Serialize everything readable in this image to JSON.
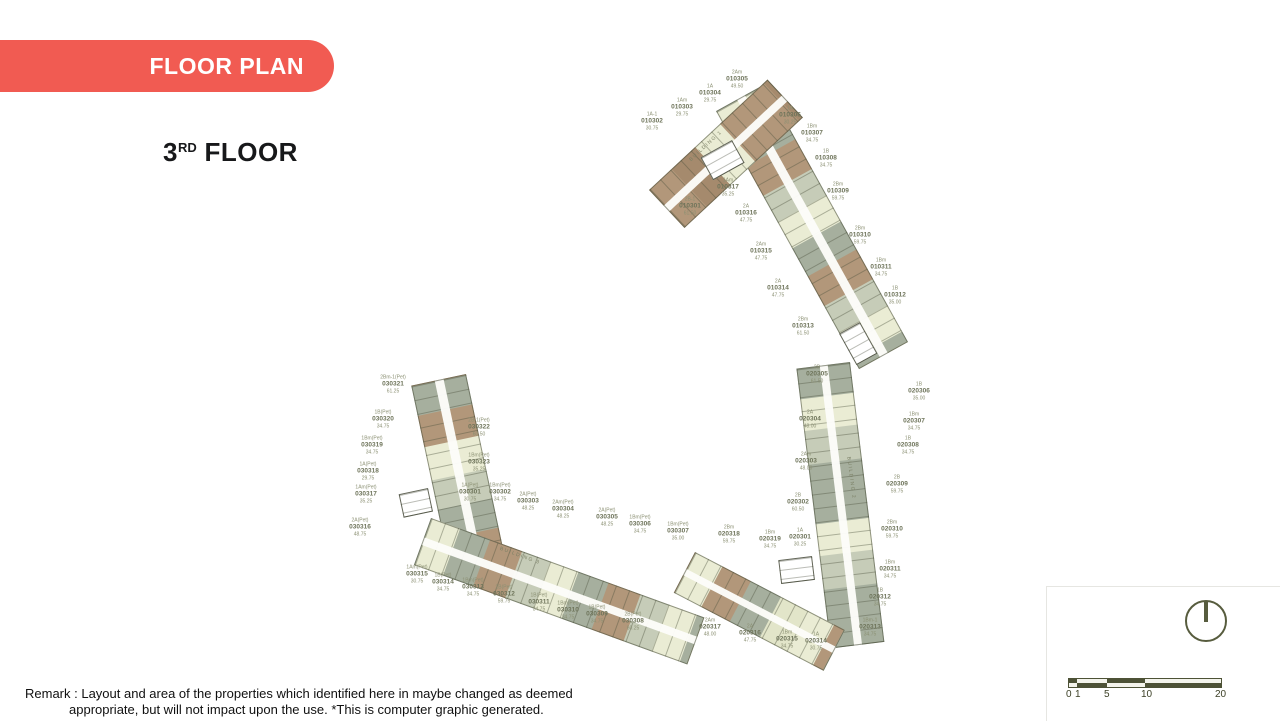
{
  "slide": {
    "badge_label": "FLOOR PLAN",
    "badge_color": "#f15b52",
    "floor_number": "3",
    "floor_suffix": "RD",
    "floor_word": " FLOOR"
  },
  "remark": {
    "line1": "Remark : Layout  and area of the properties which identified here in maybe changed as deemed",
    "line2": "appropriate, but will not impact upon the use. *This is computer graphic generated."
  },
  "scalebar": {
    "values": [
      "0",
      "1",
      "5",
      "10",
      "20"
    ],
    "dark": "#4d5236",
    "light": "#f4f4ec"
  },
  "compass": {
    "icon": "north-indicator",
    "color": "#575c3e"
  },
  "palette": {
    "tan": "#b2977a",
    "tan2": "#a58a6d",
    "sage": "#a6af9e",
    "sage2": "#c6ccb8",
    "cream": "#eaecd4",
    "cream2": "#e2e5c9",
    "outline": "#6b7058",
    "label": "#8b9073",
    "label_strong": "#6e745a"
  },
  "buildings": [
    {
      "name": "BUILDING 1",
      "units": [
        {
          "type": "2B-1",
          "no": "010301",
          "area": "61.50",
          "x": 690,
          "y": 207
        },
        {
          "type": "1A-1",
          "no": "010302",
          "area": "30.75",
          "x": 652,
          "y": 122
        },
        {
          "type": "1Am",
          "no": "010303",
          "area": "29.75",
          "x": 682,
          "y": 108
        },
        {
          "type": "1A",
          "no": "010304",
          "area": "29.75",
          "x": 710,
          "y": 94
        },
        {
          "type": "2Am",
          "no": "010305",
          "area": "49.50",
          "x": 737,
          "y": 80
        },
        {
          "type": "1A",
          "no": "010306",
          "area": "30.25",
          "x": 790,
          "y": 116
        },
        {
          "type": "1Bm",
          "no": "010307",
          "area": "34.75",
          "x": 812,
          "y": 134
        },
        {
          "type": "1B",
          "no": "010308",
          "area": "34.75",
          "x": 826,
          "y": 159
        },
        {
          "type": "2Bm",
          "no": "010309",
          "area": "59.75",
          "x": 838,
          "y": 192
        },
        {
          "type": "2Bm",
          "no": "010310",
          "area": "59.75",
          "x": 860,
          "y": 236
        },
        {
          "type": "1Bm",
          "no": "010311",
          "area": "34.75",
          "x": 881,
          "y": 268
        },
        {
          "type": "1B",
          "no": "010312",
          "area": "35.00",
          "x": 895,
          "y": 296
        },
        {
          "type": "2Bm",
          "no": "010313",
          "area": "61.50",
          "x": 803,
          "y": 327
        },
        {
          "type": "2A",
          "no": "010314",
          "area": "47.75",
          "x": 778,
          "y": 289
        },
        {
          "type": "2Am",
          "no": "010315",
          "area": "47.75",
          "x": 761,
          "y": 252
        },
        {
          "type": "2A",
          "no": "010316",
          "area": "47.75",
          "x": 746,
          "y": 214
        },
        {
          "type": "1Am",
          "no": "010317",
          "area": "35.25",
          "x": 728,
          "y": 188
        }
      ]
    },
    {
      "name": "BUILDING 2",
      "units": [
        {
          "type": "1A",
          "no": "020301",
          "area": "30.25",
          "x": 800,
          "y": 538
        },
        {
          "type": "2B",
          "no": "020302",
          "area": "60.50",
          "x": 798,
          "y": 503
        },
        {
          "type": "2Am",
          "no": "020303",
          "area": "48.00",
          "x": 806,
          "y": 462
        },
        {
          "type": "2A",
          "no": "020304",
          "area": "48.00",
          "x": 810,
          "y": 420
        },
        {
          "type": "2B",
          "no": "020305",
          "area": "61.50",
          "x": 817,
          "y": 375
        },
        {
          "type": "1B",
          "no": "020306",
          "area": "35.00",
          "x": 919,
          "y": 392
        },
        {
          "type": "1Bm",
          "no": "020307",
          "area": "34.75",
          "x": 914,
          "y": 422
        },
        {
          "type": "1B",
          "no": "020308",
          "area": "34.75",
          "x": 908,
          "y": 446
        },
        {
          "type": "2B",
          "no": "020309",
          "area": "59.75",
          "x": 897,
          "y": 485
        },
        {
          "type": "2Bm",
          "no": "020310",
          "area": "59.75",
          "x": 892,
          "y": 530
        },
        {
          "type": "1Bm",
          "no": "020311",
          "area": "34.75",
          "x": 890,
          "y": 570
        },
        {
          "type": "1B",
          "no": "020312",
          "area": "34.75",
          "x": 880,
          "y": 598
        },
        {
          "type": "1Bm-1",
          "no": "020313",
          "area": "34.75",
          "x": 870,
          "y": 628
        },
        {
          "type": "1A",
          "no": "020314",
          "area": "30.75",
          "x": 816,
          "y": 642
        },
        {
          "type": "1Bm",
          "no": "020315",
          "area": "34.75",
          "x": 787,
          "y": 640
        },
        {
          "type": "2A",
          "no": "020316",
          "area": "47.75",
          "x": 750,
          "y": 634
        },
        {
          "type": "2Am",
          "no": "020317",
          "area": "48.00",
          "x": 710,
          "y": 628
        },
        {
          "type": "2Bm",
          "no": "020318",
          "area": "59.75",
          "x": 729,
          "y": 535
        },
        {
          "type": "1Bm",
          "no": "020319",
          "area": "34.75",
          "x": 770,
          "y": 540
        }
      ]
    },
    {
      "name": "BUILDING 3",
      "units": [
        {
          "type": "1A(Pet)",
          "no": "030301",
          "area": "30.75",
          "x": 470,
          "y": 493
        },
        {
          "type": "1Bm(Pet)",
          "no": "030302",
          "area": "34.75",
          "x": 500,
          "y": 493
        },
        {
          "type": "2A(Pet)",
          "no": "030303",
          "area": "48.25",
          "x": 528,
          "y": 502
        },
        {
          "type": "2Am(Pet)",
          "no": "030304",
          "area": "48.25",
          "x": 563,
          "y": 510
        },
        {
          "type": "2A(Pet)",
          "no": "030305",
          "area": "48.25",
          "x": 607,
          "y": 518
        },
        {
          "type": "1Bm(Pet)",
          "no": "030306",
          "area": "34.75",
          "x": 640,
          "y": 525
        },
        {
          "type": "1Bm(Pet)",
          "no": "030307",
          "area": "35.00",
          "x": 678,
          "y": 532
        },
        {
          "type": "2B(Pet)",
          "no": "030308",
          "area": "60.25",
          "x": 633,
          "y": 622
        },
        {
          "type": "1B(Pet)",
          "no": "030309",
          "area": "34.75",
          "x": 597,
          "y": 615
        },
        {
          "type": "1Bm(Pet)",
          "no": "030310",
          "area": "34.75",
          "x": 568,
          "y": 611
        },
        {
          "type": "1B(Pet)",
          "no": "030311",
          "area": "34.75",
          "x": 539,
          "y": 603
        },
        {
          "type": "2B(Pet)",
          "no": "030312",
          "area": "59.75",
          "x": 504,
          "y": 595
        },
        {
          "type": "1Bm(Pet)",
          "no": "030313",
          "area": "34.75",
          "x": 473,
          "y": 588
        },
        {
          "type": "1B(Pet)",
          "no": "030314",
          "area": "34.75",
          "x": 443,
          "y": 583
        },
        {
          "type": "1Am(Pet)",
          "no": "030315",
          "area": "30.75",
          "x": 417,
          "y": 575
        },
        {
          "type": "2A(Pet)",
          "no": "030316",
          "area": "48.75",
          "x": 360,
          "y": 528
        },
        {
          "type": "1Am(Pet)",
          "no": "030317",
          "area": "35.25",
          "x": 366,
          "y": 495
        },
        {
          "type": "1A(Pet)",
          "no": "030318",
          "area": "29.75",
          "x": 368,
          "y": 472
        },
        {
          "type": "1Bm(Pet)",
          "no": "030319",
          "area": "34.75",
          "x": 372,
          "y": 446
        },
        {
          "type": "1B(Pet)",
          "no": "030320",
          "area": "34.75",
          "x": 383,
          "y": 420
        },
        {
          "type": "2Bm-1(Pet)",
          "no": "030321",
          "area": "61.25",
          "x": 393,
          "y": 385
        },
        {
          "type": "2B-1(Pet)",
          "no": "030322",
          "area": "60.50",
          "x": 479,
          "y": 428
        },
        {
          "type": "1Bm(Pet)",
          "no": "030323",
          "area": "35.25",
          "x": 479,
          "y": 463
        }
      ]
    }
  ]
}
